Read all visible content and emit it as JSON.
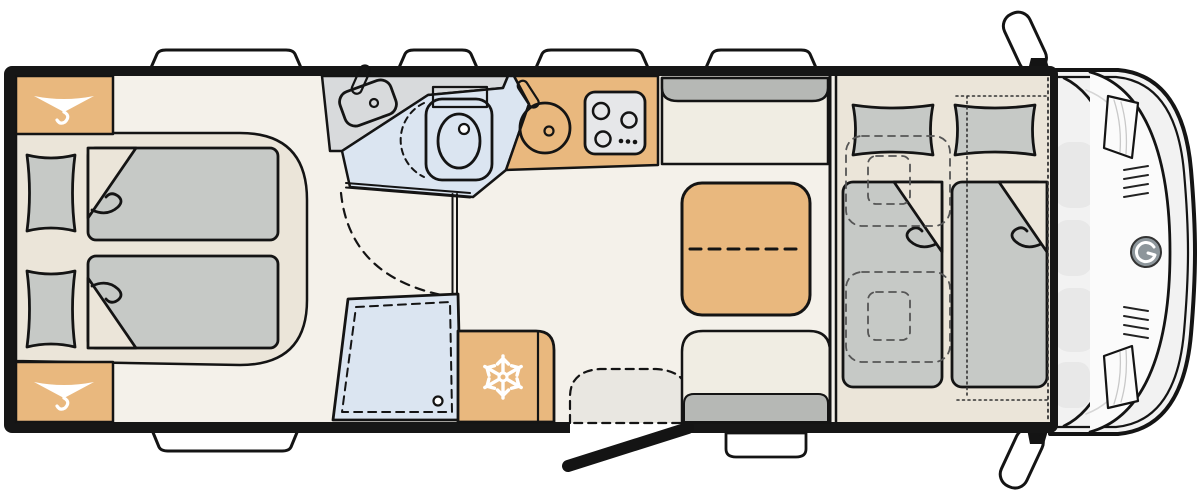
{
  "floorplan": {
    "vehicle": "motorhome",
    "view": "top-down",
    "rear_bedroom": {
      "wardrobes": 2,
      "single_beds": 2,
      "pillows": 2
    },
    "washroom": {
      "washbasin": 1,
      "toilet": 1,
      "shower_drain": 1
    },
    "kitchen": {
      "sink": 1,
      "hob_burners": 3,
      "hob_knobs": 3,
      "refrigerator": 1
    },
    "dinette": {
      "benches": 2,
      "table_extendable_split": true
    },
    "front_bed": {
      "mattresses": 2,
      "pillows": 2,
      "cab_seats_dashed_below": 2
    },
    "cab": {
      "side_mirrors": 2,
      "brand_logo": 1
    },
    "entrance": {
      "open_door": 1,
      "swing_arc": 1,
      "entry_step": 1
    },
    "edge_windows": {
      "top": 4,
      "bottom": 1
    }
  },
  "icons": [
    {
      "name": "hanger-icon",
      "meaning": "wardrobe",
      "count": 2
    },
    {
      "name": "snowflake-icon",
      "meaning": "refrigerator",
      "count": 1
    },
    {
      "name": "brand-swirl-icon",
      "meaning": "vehicle logo",
      "count": 1
    }
  ],
  "colors": {
    "wall": "#161616",
    "floor": "#f4f1ea",
    "plat": "#ebe5d9",
    "wood": "#e9b87e",
    "matt": "#c6c9c6",
    "wet": "#dbe5f1",
    "cnt": "#d8dadc",
    "app": "#e6e7e9",
    "bench": "#f0ede3",
    "back": "#b6b8b5",
    "swing": "#e9e7e1",
    "cab": "#f2f2f2",
    "cabin": "#e8e8e8",
    "glass": "#fbfbfb",
    "logo": "#8d969b",
    "line": "#141414",
    "white": "#ffffff",
    "outside": "#ffffff"
  }
}
